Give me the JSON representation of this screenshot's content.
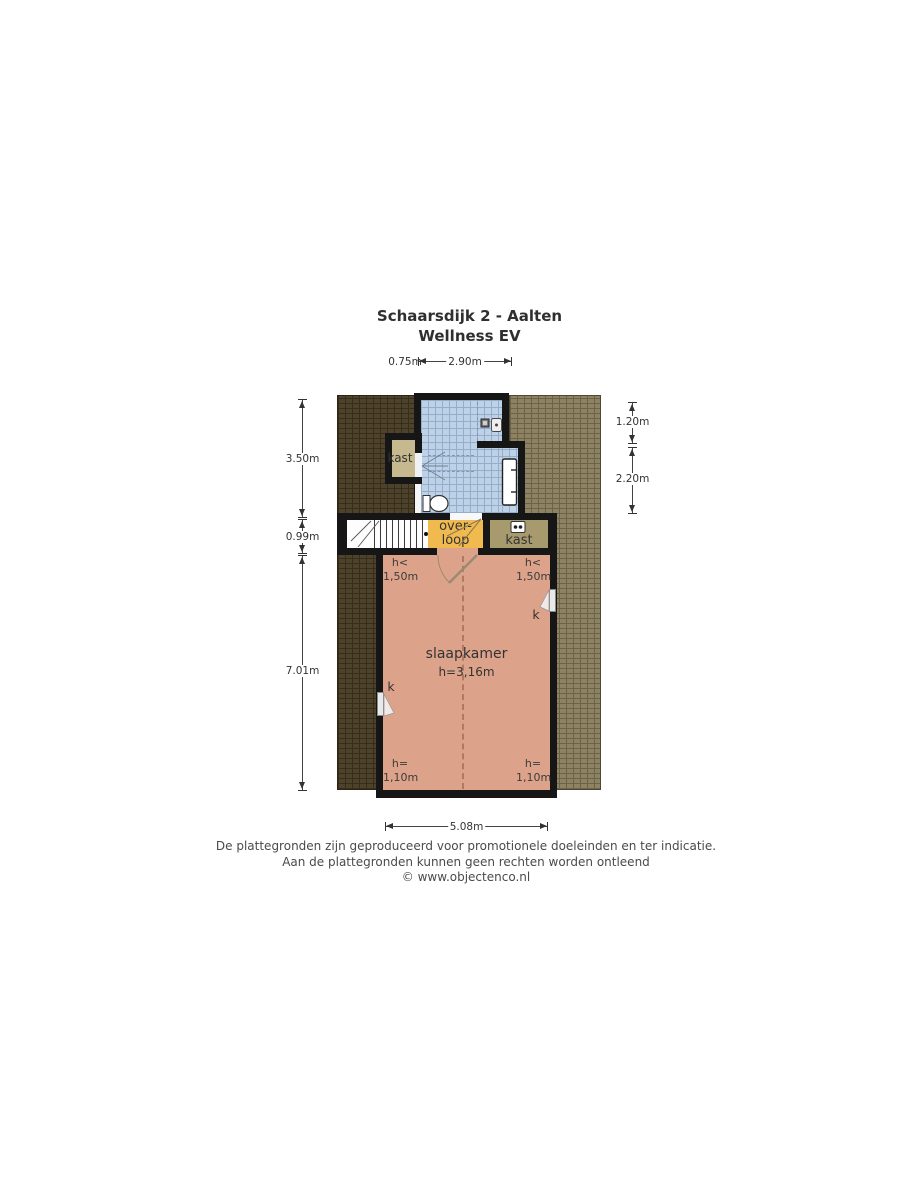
{
  "title": {
    "line1": "Schaarsdijk 2 - Aalten",
    "line2": "Wellness EV"
  },
  "dimensions": {
    "top_kast": "0.75m",
    "top_bathroom": "2.90m",
    "left_top": "3.50m",
    "left_middle": "0.99m",
    "left_bottom": "7.01m",
    "right_top": "1.20m",
    "right_bottom": "2.20m",
    "bottom": "5.08m"
  },
  "rooms": {
    "kast_top": {
      "label": "kast"
    },
    "overloop": {
      "label_line1": "over-",
      "label_line2": "loop"
    },
    "kast_middle": {
      "label": "kast"
    },
    "slaapkamer": {
      "label": "slaapkamer",
      "ceiling_height": "h=3,16m"
    }
  },
  "height_markers": {
    "top_left": {
      "line1": "h<",
      "line2": "1,50m"
    },
    "top_right": {
      "line1": "h<",
      "line2": "1,50m"
    },
    "bottom_left": {
      "line1": "h=",
      "line2": "1,10m"
    },
    "bottom_right": {
      "line1": "h=",
      "line2": "1,10m"
    }
  },
  "windows": {
    "left_label": "k",
    "right_label": "k"
  },
  "icons": [
    "toilet-icon",
    "double-sink-icon",
    "ventilation-unit-icon",
    "shower-drain-icon",
    "washbasin-icon",
    "stairs-icon"
  ],
  "footer": {
    "line1": "De plattegronden zijn geproduceerd voor promotionele doeleinden en ter indicatie.",
    "line2": "Aan de plattegronden kunnen geen rechten worden ontleend",
    "line3": "© www.objectenco.nl"
  },
  "colors": {
    "roof-dark": "#4e432a",
    "roof-dark-line": "#362e1c",
    "roof-light": "#8d8262",
    "roof-light-line": "#6d6349",
    "tile": "#bdd2e7",
    "tile-line": "#95adca",
    "kast-tan": "#c6b88f",
    "kast-olive": "#a79b6e",
    "overloop": "#f1ba4e",
    "bedroom": "#dda38a",
    "wall": "#161616"
  }
}
